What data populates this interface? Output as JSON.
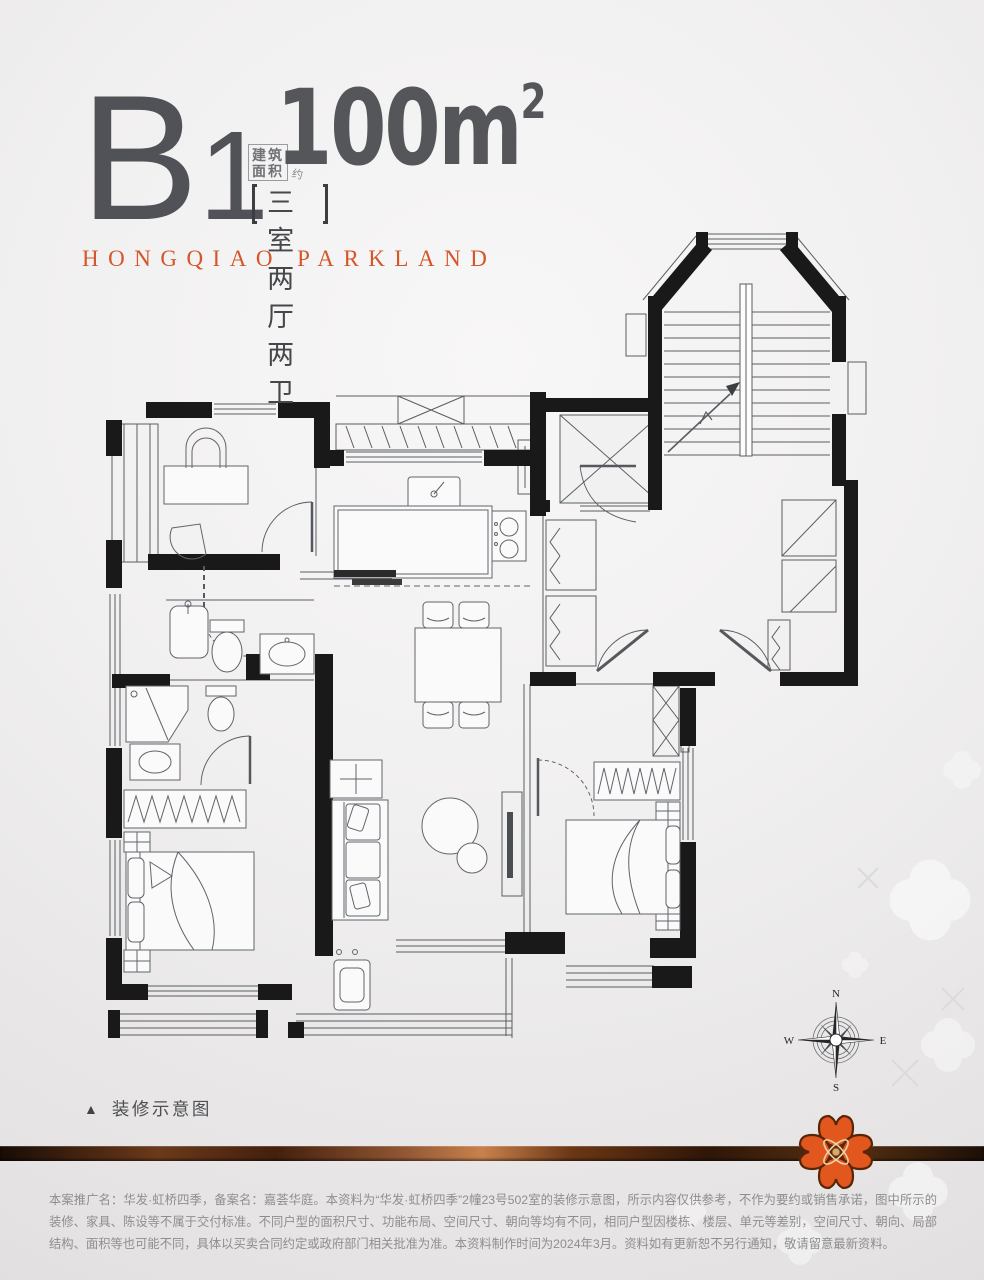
{
  "header": {
    "plan_code_letter": "B",
    "plan_code_number": "1",
    "area_label_top": "建筑",
    "area_label_bottom": "面积",
    "area_label_approx": "约",
    "area_value": "100m",
    "area_exponent": "2",
    "layout_label": "三室两厅两卫",
    "brand_name": "HONGQIAO PARKLAND"
  },
  "caption": {
    "marker": "▲",
    "label": "装修示意图"
  },
  "compass": {
    "north": "N",
    "south": "S",
    "east": "E",
    "west": "W"
  },
  "footer": {
    "disclaimer": "本案推广名：华发·虹桥四季，备案名：嘉荟华庭。本资料为“华发·虹桥四季”2幢23号502室的装修示意图，所示内容仅供参考，不作为要约或销售承诺，图中所示的装修、家具、陈设等不属于交付标准。不同户型的面积尺寸、功能布局、空间尺寸、朝向等均有不同，相同户型因楼栋、楼层、单元等差别，空间尺寸、朝向、局部结构、面积等也可能不同，具体以买卖合同约定或政府部门相关批准为准。本资料制作时间为2024年3月。资料如有更新恕不另行通知，敬请留意最新资料。"
  },
  "colors": {
    "accent_orange": "#D4562A",
    "title_gray": "#55565A",
    "wall_black": "#191919",
    "band_brown": "#5A2F14",
    "logo_orange": "#E2571E"
  }
}
